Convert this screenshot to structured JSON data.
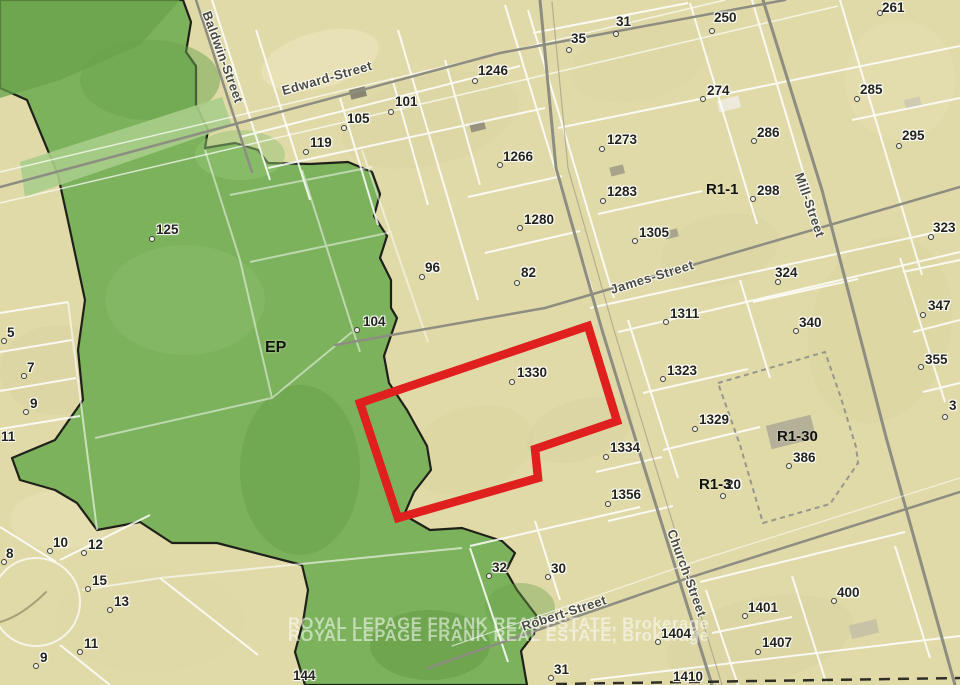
{
  "map": {
    "attribution": {
      "line1": "ROYAL LEPAGE FRANK REAL ESTATE, Brokerage",
      "line2": "ROYAL LEPAGE FRANK REAL ESTATE, Brokerage"
    },
    "colors": {
      "ep_green": "#7cb25c",
      "ep_green_dark": "#68a14a",
      "parcel_beige": "#e0daa8",
      "subject_outline_red": "#e01f1f",
      "road_gray": "#8d8d82",
      "parcel_line_white": "#ffffff",
      "boundary_black": "#20201a"
    },
    "zones": [
      {
        "label": "EP",
        "x": 265,
        "y": 340,
        "size": 16
      },
      {
        "label": "R1-1",
        "x": 706,
        "y": 182,
        "size": 15
      },
      {
        "label": "R1-30",
        "x": 777,
        "y": 429,
        "size": 15
      },
      {
        "label": "R1-3",
        "x": 699,
        "y": 477,
        "size": 15
      }
    ],
    "streets": [
      {
        "label": "Baldwin-Street",
        "x": 223,
        "y": 57,
        "rotate": 70
      },
      {
        "label": "Edward-Street",
        "x": 327,
        "y": 78,
        "rotate": -16
      },
      {
        "label": "James-Street",
        "x": 652,
        "y": 277,
        "rotate": -17
      },
      {
        "label": "Mill-Street",
        "x": 810,
        "y": 205,
        "rotate": 71
      },
      {
        "label": "Church-Street",
        "x": 687,
        "y": 573,
        "rotate": 70
      },
      {
        "label": "Robert-Street",
        "x": 564,
        "y": 613,
        "rotate": -18
      }
    ],
    "parcels": [
      {
        "label": "31",
        "x": 616,
        "y": 15,
        "dot": [
          616,
          34
        ]
      },
      {
        "label": "35",
        "x": 571,
        "y": 32,
        "dot": [
          569,
          50
        ]
      },
      {
        "label": "250",
        "x": 714,
        "y": 11,
        "dot": [
          712,
          31
        ]
      },
      {
        "label": "261",
        "x": 882,
        "y": 1,
        "dot": [
          880,
          13
        ]
      },
      {
        "label": "1246",
        "x": 478,
        "y": 64,
        "dot": [
          475,
          81
        ]
      },
      {
        "label": "101",
        "x": 395,
        "y": 95,
        "dot": [
          391,
          112
        ]
      },
      {
        "label": "274",
        "x": 707,
        "y": 84,
        "dot": [
          703,
          99
        ]
      },
      {
        "label": "285",
        "x": 860,
        "y": 83,
        "dot": [
          857,
          99
        ]
      },
      {
        "label": "105",
        "x": 347,
        "y": 112,
        "dot": [
          344,
          128
        ]
      },
      {
        "label": "119",
        "x": 310,
        "y": 136,
        "dot": [
          306,
          152
        ]
      },
      {
        "label": "286",
        "x": 757,
        "y": 126,
        "dot": [
          754,
          141
        ]
      },
      {
        "label": "295",
        "x": 902,
        "y": 129,
        "dot": [
          899,
          146
        ]
      },
      {
        "label": "1266",
        "x": 503,
        "y": 150,
        "dot": [
          500,
          165
        ]
      },
      {
        "label": "1273",
        "x": 607,
        "y": 133,
        "dot": [
          602,
          149
        ]
      },
      {
        "label": "1283",
        "x": 607,
        "y": 185,
        "dot": [
          603,
          201
        ]
      },
      {
        "label": "298",
        "x": 757,
        "y": 184,
        "dot": [
          753,
          199
        ]
      },
      {
        "label": "1280",
        "x": 524,
        "y": 213,
        "dot": [
          520,
          228
        ]
      },
      {
        "label": "1305",
        "x": 639,
        "y": 226,
        "dot": [
          635,
          241
        ]
      },
      {
        "label": "323",
        "x": 933,
        "y": 221,
        "dot": [
          931,
          237
        ]
      },
      {
        "label": "96",
        "x": 425,
        "y": 261,
        "dot": [
          422,
          277
        ]
      },
      {
        "label": "82",
        "x": 521,
        "y": 266,
        "dot": [
          517,
          283
        ]
      },
      {
        "label": "324",
        "x": 775,
        "y": 266,
        "dot": [
          778,
          282
        ]
      },
      {
        "label": "104",
        "x": 363,
        "y": 315,
        "dot": [
          357,
          330
        ]
      },
      {
        "label": "125",
        "x": 156,
        "y": 223,
        "dot": [
          152,
          239
        ]
      },
      {
        "label": "347",
        "x": 928,
        "y": 299,
        "dot": [
          923,
          315
        ]
      },
      {
        "label": "340",
        "x": 799,
        "y": 316,
        "dot": [
          796,
          331
        ]
      },
      {
        "label": "1311",
        "x": 670,
        "y": 307,
        "dot": [
          666,
          322
        ]
      },
      {
        "label": "355",
        "x": 925,
        "y": 353,
        "dot": [
          921,
          367
        ]
      },
      {
        "label": "3",
        "x": 949,
        "y": 399,
        "dot": [
          945,
          417
        ]
      },
      {
        "label": "1330",
        "x": 517,
        "y": 366,
        "dot": [
          512,
          382
        ]
      },
      {
        "label": "1323",
        "x": 667,
        "y": 364,
        "dot": [
          663,
          379
        ]
      },
      {
        "label": "1329",
        "x": 699,
        "y": 413,
        "dot": [
          695,
          429
        ]
      },
      {
        "label": "386",
        "x": 793,
        "y": 451,
        "dot": [
          789,
          466
        ]
      },
      {
        "label": "1334",
        "x": 610,
        "y": 441,
        "dot": [
          606,
          457
        ]
      },
      {
        "label": "20",
        "x": 726,
        "y": 478,
        "dot": [
          723,
          496
        ]
      },
      {
        "label": "1356",
        "x": 611,
        "y": 488,
        "dot": [
          608,
          504
        ]
      },
      {
        "label": "32",
        "x": 492,
        "y": 561,
        "dot": [
          489,
          576
        ]
      },
      {
        "label": "30",
        "x": 551,
        "y": 562,
        "dot": [
          548,
          577
        ]
      },
      {
        "label": "31",
        "x": 554,
        "y": 663,
        "dot": [
          551,
          678
        ]
      },
      {
        "label": "144",
        "x": 293,
        "y": 669,
        "dot": null
      },
      {
        "label": "1404",
        "x": 661,
        "y": 627,
        "dot": [
          658,
          642
        ]
      },
      {
        "label": "1401",
        "x": 748,
        "y": 601,
        "dot": [
          745,
          616
        ]
      },
      {
        "label": "400",
        "x": 837,
        "y": 586,
        "dot": [
          834,
          601
        ]
      },
      {
        "label": "1407",
        "x": 762,
        "y": 636,
        "dot": [
          758,
          652
        ]
      },
      {
        "label": "1410",
        "x": 673,
        "y": 670,
        "dot": null
      },
      {
        "label": "5",
        "x": 7,
        "y": 326,
        "dot": [
          4,
          341
        ]
      },
      {
        "label": "7",
        "x": 27,
        "y": 361,
        "dot": [
          24,
          376
        ]
      },
      {
        "label": "9",
        "x": 30,
        "y": 397,
        "dot": [
          26,
          412
        ]
      },
      {
        "label": "11",
        "x": 1,
        "y": 430,
        "dot": null
      },
      {
        "label": "8",
        "x": 6,
        "y": 547,
        "dot": [
          4,
          562
        ]
      },
      {
        "label": "10",
        "x": 53,
        "y": 536,
        "dot": [
          50,
          551
        ]
      },
      {
        "label": "12",
        "x": 88,
        "y": 538,
        "dot": [
          84,
          553
        ]
      },
      {
        "label": "15",
        "x": 92,
        "y": 574,
        "dot": [
          88,
          589
        ]
      },
      {
        "label": "13",
        "x": 114,
        "y": 595,
        "dot": [
          110,
          610
        ]
      },
      {
        "label": "11",
        "x": 84,
        "y": 637,
        "dot": [
          80,
          652
        ]
      },
      {
        "label": "9",
        "x": 40,
        "y": 651,
        "dot": [
          36,
          666
        ]
      }
    ]
  }
}
